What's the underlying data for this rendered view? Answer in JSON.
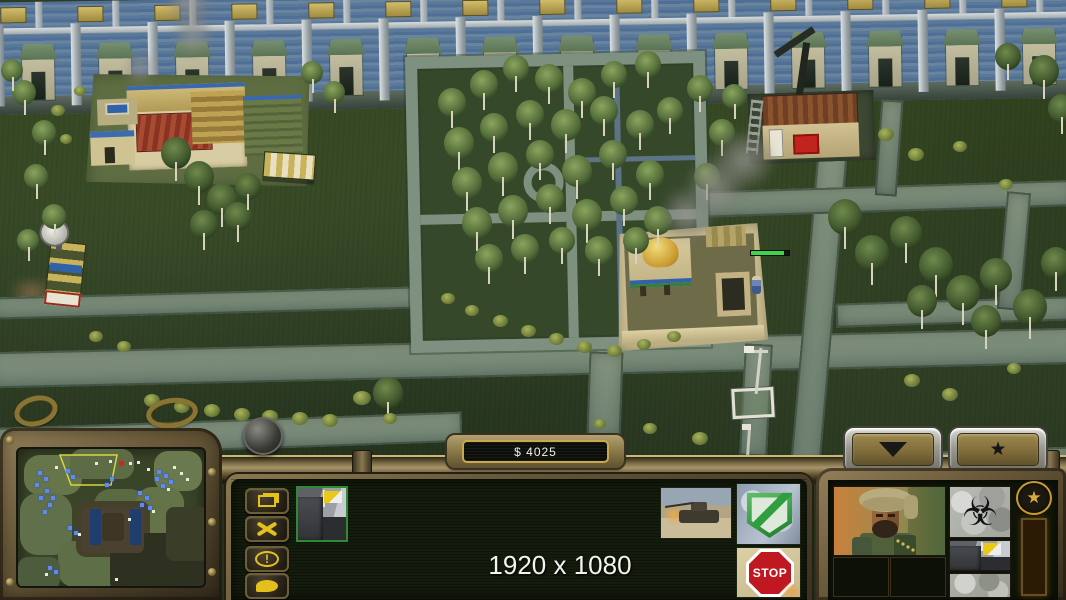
{
  "hud": {
    "money_label": "$ 4025",
    "resolution_overlay": "1920 x 1080",
    "stop_label": "STOP",
    "icons": {
      "biohazard": "☣",
      "star": "★",
      "rank_star": "★"
    },
    "colors": {
      "bronze": "#8a7448",
      "panel_green": "#141c0d",
      "glyph_yellow": "#e5c01d",
      "xp_orange": "#e09420",
      "shield_green": "#2f9e41",
      "stop_red": "#c01820",
      "money_text": "#f0f0ea"
    },
    "xp": {
      "segments": 8,
      "filled": 7
    }
  },
  "minimap": {
    "frustum": "42,6 99,6 93,36 53,36",
    "patches": [
      [
        6,
        6,
        58,
        40,
        "#66754a",
        16
      ],
      [
        52,
        0,
        64,
        30,
        "#5d6c44",
        12
      ],
      [
        136,
        2,
        48,
        40,
        "#6a7a4e",
        14
      ],
      [
        2,
        44,
        52,
        62,
        "#60704a",
        18
      ],
      [
        76,
        40,
        52,
        52,
        "#5a6a42",
        16
      ],
      [
        118,
        38,
        48,
        48,
        "#647448",
        16
      ],
      [
        40,
        92,
        62,
        46,
        "#5e6e46",
        16
      ],
      [
        58,
        52,
        74,
        56,
        "#45402a",
        10
      ],
      [
        92,
        84,
        98,
        57,
        "#2e3120",
        8
      ],
      [
        148,
        58,
        42,
        54,
        "#3a3d28",
        8
      ],
      [
        64,
        58,
        62,
        46,
        "#4a4130",
        6
      ],
      [
        84,
        64,
        22,
        28,
        "#3f3524",
        4
      ],
      [
        0,
        108,
        42,
        33,
        "#4e5c3e",
        10
      ],
      [
        72,
        60,
        11,
        36,
        "#1f3e6e",
        2
      ],
      [
        112,
        60,
        11,
        36,
        "#1f3e6e",
        2
      ]
    ],
    "friendly_blips": [
      [
        20,
        22
      ],
      [
        26,
        28
      ],
      [
        17,
        34
      ],
      [
        27,
        40
      ],
      [
        21,
        47
      ],
      [
        30,
        54
      ],
      [
        25,
        61
      ],
      [
        33,
        47
      ],
      [
        48,
        20
      ],
      [
        53,
        26
      ],
      [
        92,
        28
      ],
      [
        87,
        34
      ],
      [
        139,
        21
      ],
      [
        146,
        25
      ],
      [
        151,
        31
      ],
      [
        143,
        35
      ],
      [
        137,
        28
      ],
      [
        120,
        42
      ],
      [
        127,
        47
      ],
      [
        122,
        54
      ],
      [
        130,
        57
      ],
      [
        50,
        77
      ],
      [
        56,
        82
      ],
      [
        30,
        117
      ],
      [
        36,
        121
      ]
    ],
    "neutral_blips": [
      [
        37,
        17
      ],
      [
        77,
        13
      ],
      [
        91,
        11
      ],
      [
        111,
        13
      ],
      [
        119,
        12
      ],
      [
        129,
        19
      ],
      [
        155,
        17
      ],
      [
        162,
        23
      ],
      [
        168,
        29
      ],
      [
        149,
        39
      ],
      [
        134,
        61
      ],
      [
        110,
        69
      ],
      [
        60,
        84
      ],
      [
        27,
        124
      ],
      [
        97,
        129
      ]
    ],
    "enemy_blips": [
      [
        101,
        12
      ]
    ]
  },
  "world": {
    "wall": {
      "sections": 14,
      "section_width": 77
    },
    "trees": [
      [
        452,
        102,
        28,
        0
      ],
      [
        484,
        84,
        28,
        0
      ],
      [
        516,
        68,
        26,
        0
      ],
      [
        549,
        78,
        28,
        0
      ],
      [
        582,
        92,
        28,
        0
      ],
      [
        614,
        74,
        26,
        0
      ],
      [
        648,
        64,
        26,
        0
      ],
      [
        459,
        142,
        30,
        0
      ],
      [
        494,
        127,
        28,
        0
      ],
      [
        530,
        114,
        28,
        0
      ],
      [
        566,
        124,
        30,
        0
      ],
      [
        604,
        110,
        28,
        0
      ],
      [
        640,
        124,
        28,
        0
      ],
      [
        670,
        110,
        26,
        0
      ],
      [
        467,
        182,
        30,
        0
      ],
      [
        503,
        167,
        30,
        0
      ],
      [
        540,
        154,
        28,
        0
      ],
      [
        577,
        170,
        30,
        0
      ],
      [
        613,
        154,
        28,
        0
      ],
      [
        650,
        174,
        28,
        0
      ],
      [
        477,
        222,
        30,
        0
      ],
      [
        513,
        210,
        30,
        0
      ],
      [
        550,
        198,
        28,
        0
      ],
      [
        587,
        214,
        30,
        0
      ],
      [
        624,
        200,
        28,
        0
      ],
      [
        658,
        220,
        28,
        0
      ],
      [
        489,
        258,
        28,
        0
      ],
      [
        525,
        248,
        28,
        0
      ],
      [
        562,
        240,
        26,
        0
      ],
      [
        599,
        250,
        28,
        0
      ],
      [
        636,
        240,
        26,
        0
      ],
      [
        24,
        92,
        24,
        0
      ],
      [
        44,
        132,
        24,
        0
      ],
      [
        36,
        176,
        24,
        0
      ],
      [
        54,
        216,
        24,
        0
      ],
      [
        28,
        240,
        22,
        0
      ],
      [
        12,
        70,
        22,
        0
      ],
      [
        176,
        152,
        30,
        1
      ],
      [
        199,
        176,
        30,
        1
      ],
      [
        222,
        198,
        30,
        1
      ],
      [
        204,
        224,
        28,
        1
      ],
      [
        238,
        216,
        28,
        1
      ],
      [
        248,
        186,
        26,
        1
      ],
      [
        312,
        72,
        22,
        0
      ],
      [
        334,
        92,
        22,
        0
      ],
      [
        700,
        88,
        26,
        0
      ],
      [
        722,
        132,
        26,
        0
      ],
      [
        707,
        176,
        26,
        0
      ],
      [
        734,
        96,
        24,
        0
      ],
      [
        845,
        216,
        34,
        1
      ],
      [
        872,
        252,
        34,
        1
      ],
      [
        906,
        232,
        32,
        1
      ],
      [
        936,
        264,
        34,
        1
      ],
      [
        963,
        292,
        34,
        1
      ],
      [
        996,
        274,
        32,
        1
      ],
      [
        1030,
        306,
        34,
        1
      ],
      [
        1056,
        262,
        30,
        1
      ],
      [
        922,
        300,
        30,
        1
      ],
      [
        986,
        320,
        30,
        1
      ],
      [
        1044,
        70,
        30,
        1
      ],
      [
        1062,
        108,
        28,
        1
      ],
      [
        1008,
        56,
        26,
        1
      ],
      [
        388,
        392,
        30,
        1
      ]
    ],
    "bushes": [
      [
        152,
        402,
        16
      ],
      [
        182,
        408,
        16
      ],
      [
        212,
        412,
        16
      ],
      [
        242,
        416,
        16
      ],
      [
        270,
        418,
        16
      ],
      [
        300,
        420,
        16
      ],
      [
        330,
        422,
        16
      ],
      [
        362,
        400,
        18
      ],
      [
        390,
        420,
        14
      ],
      [
        96,
        338,
        14
      ],
      [
        124,
        348,
        14
      ],
      [
        58,
        112,
        14
      ],
      [
        80,
        92,
        12
      ],
      [
        66,
        140,
        12
      ],
      [
        448,
        300,
        14
      ],
      [
        472,
        312,
        14
      ],
      [
        500,
        322,
        15
      ],
      [
        528,
        332,
        15
      ],
      [
        556,
        340,
        15
      ],
      [
        584,
        348,
        15
      ],
      [
        614,
        352,
        15
      ],
      [
        644,
        346,
        14
      ],
      [
        674,
        338,
        14
      ],
      [
        886,
        136,
        16
      ],
      [
        916,
        156,
        16
      ],
      [
        960,
        148,
        14
      ],
      [
        1006,
        186,
        14
      ],
      [
        912,
        382,
        16
      ],
      [
        950,
        396,
        16
      ],
      [
        1014,
        370,
        14
      ],
      [
        700,
        440,
        16
      ],
      [
        650,
        430,
        14
      ],
      [
        600,
        425,
        12
      ]
    ]
  }
}
